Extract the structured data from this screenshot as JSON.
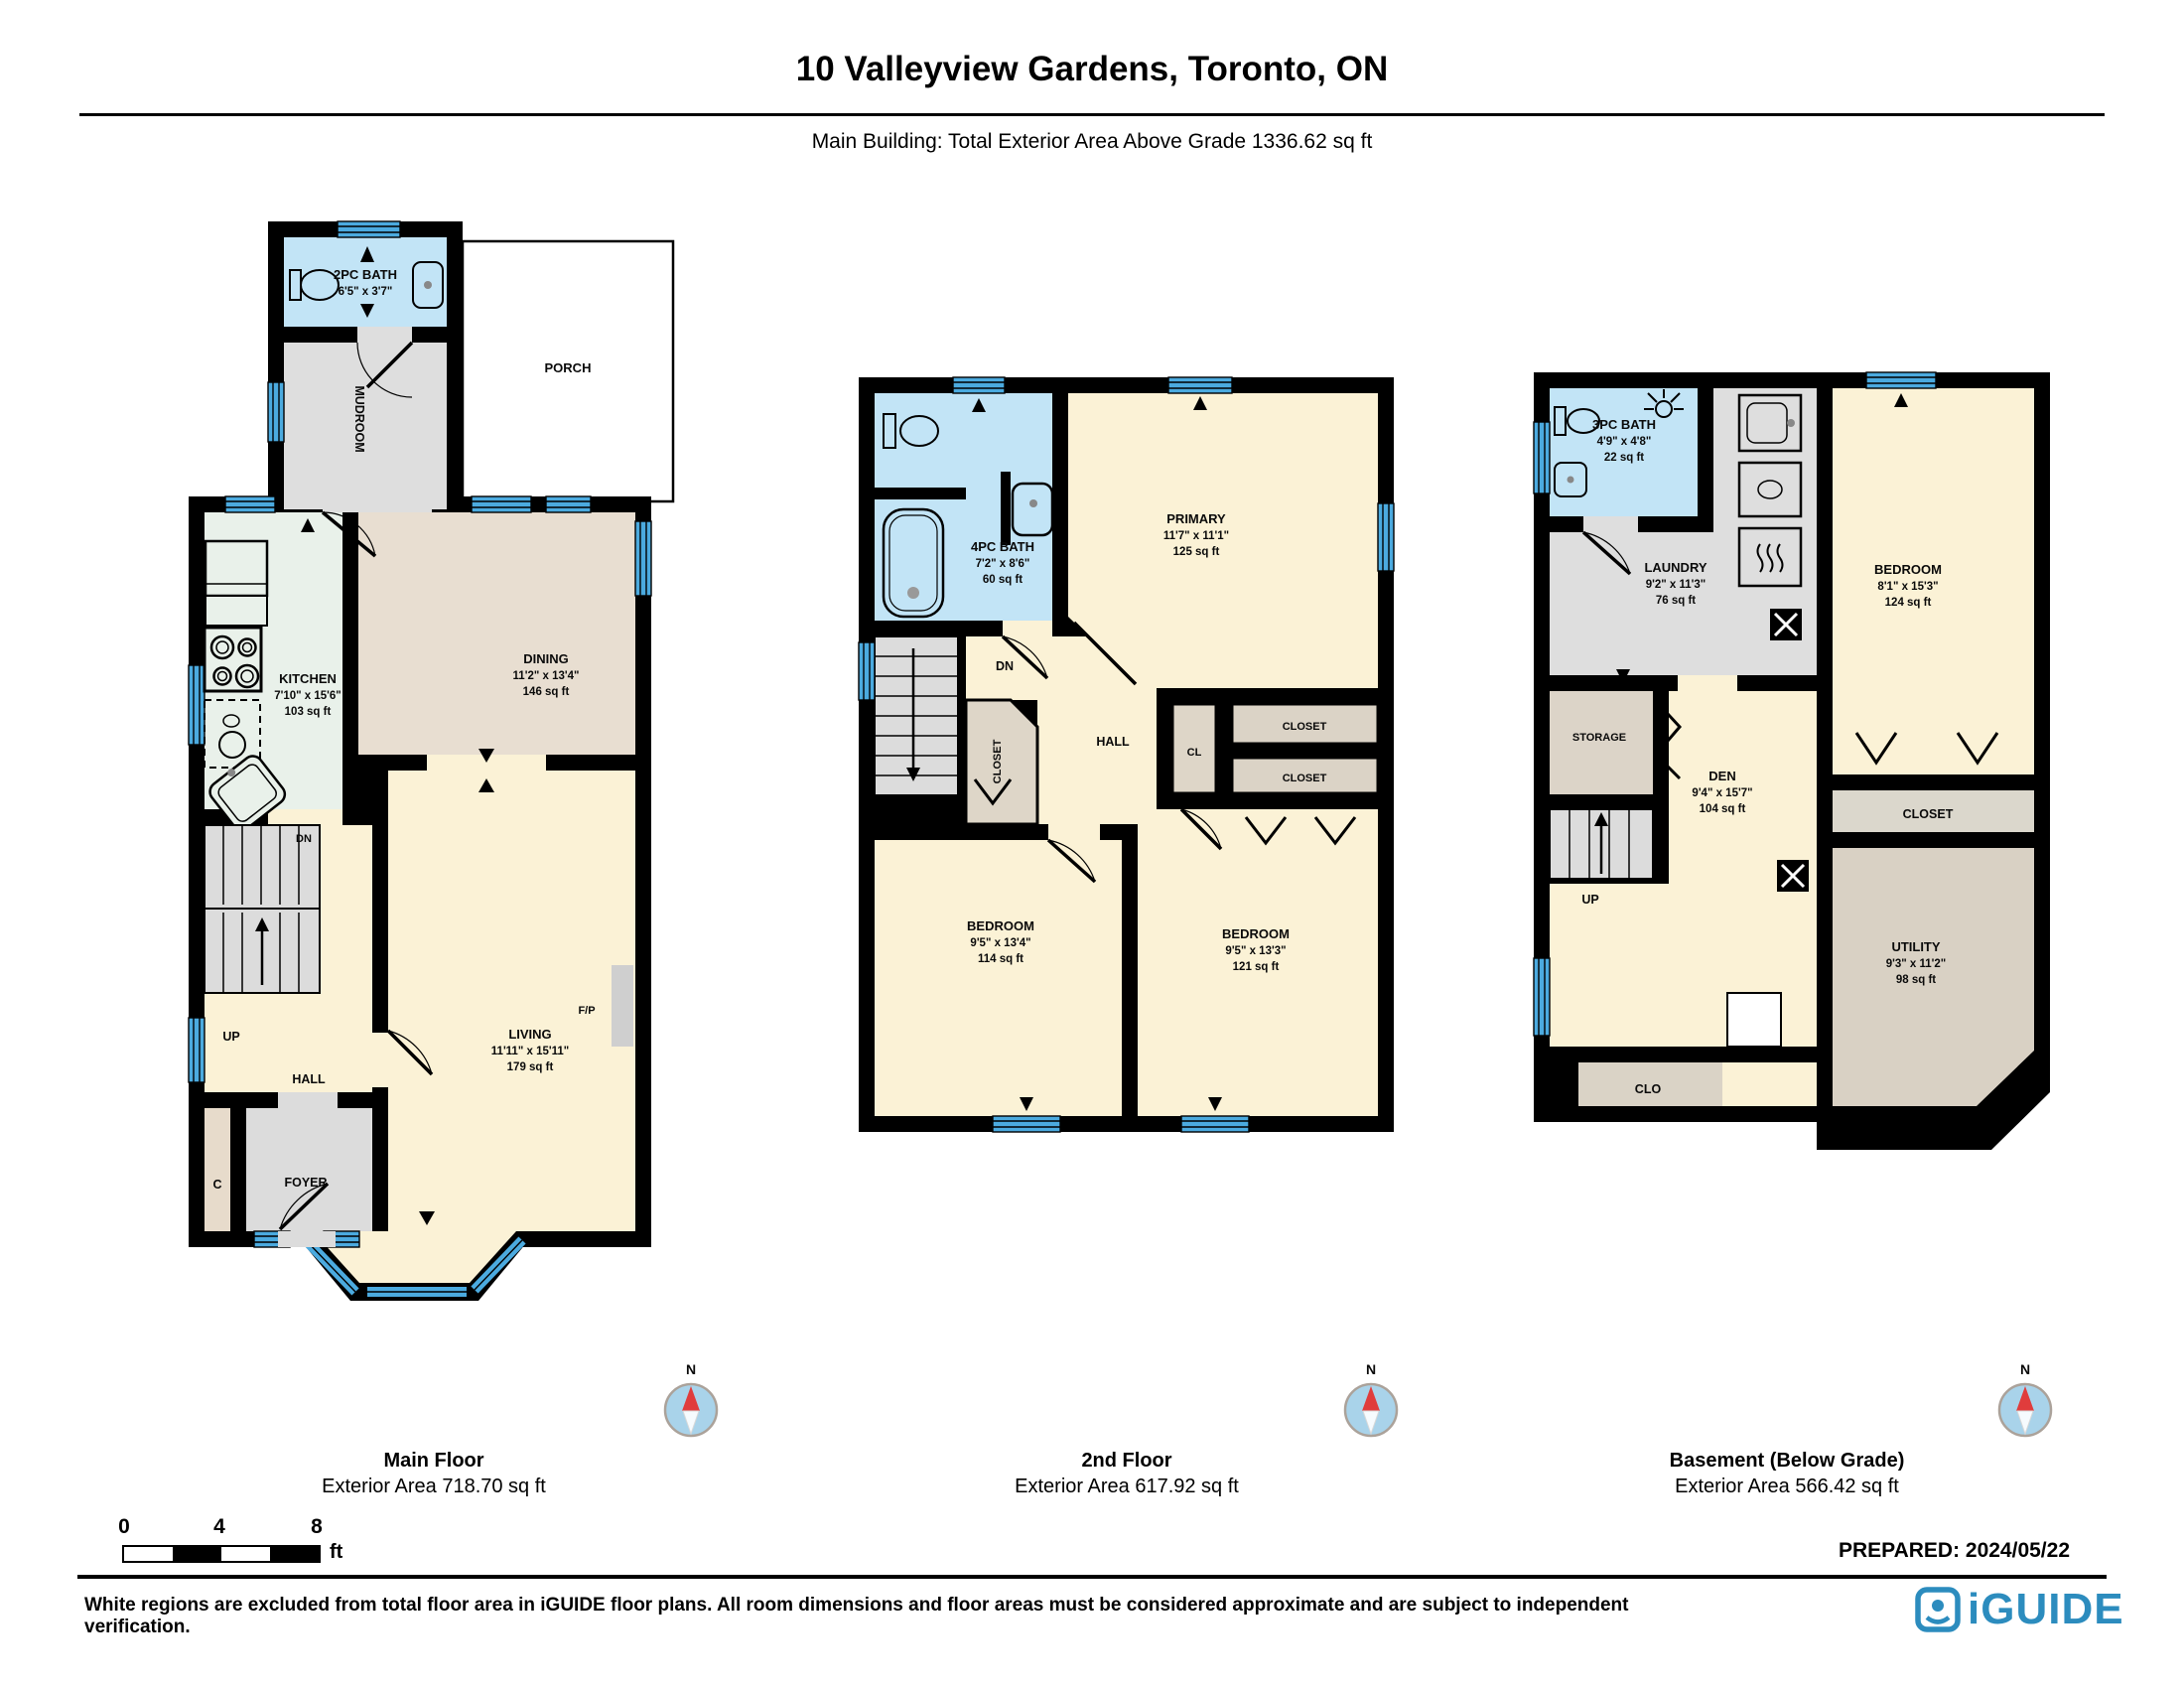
{
  "header": {
    "title": "10 Valleyview Gardens, Toronto, ON",
    "subtitle": "Main Building: Total Exterior Area Above Grade 1336.62 sq ft"
  },
  "plans": {
    "main": {
      "bath2pc": {
        "name": "2PC BATH",
        "dims": "6'5\" x 3'7\""
      },
      "mudroom": "MUDROOM",
      "porch": "PORCH",
      "kitchen": {
        "name": "KITCHEN",
        "dims": "7'10\" x 15'6\"",
        "area": "103 sq ft"
      },
      "dining": {
        "name": "DINING",
        "dims": "11'2\" x 13'4\"",
        "area": "146 sq ft"
      },
      "living": {
        "name": "LIVING",
        "dims": "11'11\" x 15'11\"",
        "area": "179 sq ft"
      },
      "hall": "HALL",
      "up": "UP",
      "dn": "DN",
      "foyer": "FOYER",
      "c": "C",
      "fp": "F/P"
    },
    "second": {
      "bath4pc": {
        "name": "4PC BATH",
        "dims": "7'2\" x 8'6\"",
        "area": "60 sq ft"
      },
      "primary": {
        "name": "PRIMARY",
        "dims": "11'7\" x 11'1\"",
        "area": "125 sq ft"
      },
      "dn": "DN",
      "closet_rot": "CLOSET",
      "hall": "HALL",
      "cl": "CL",
      "closet_a": "CLOSET",
      "closet_b": "CLOSET",
      "bedroom1": {
        "name": "BEDROOM",
        "dims": "9'5\" x 13'4\"",
        "area": "114 sq ft"
      },
      "bedroom2": {
        "name": "BEDROOM",
        "dims": "9'5\" x 13'3\"",
        "area": "121 sq ft"
      }
    },
    "basement": {
      "bath3pc": {
        "name": "3PC BATH",
        "dims": "4'9\" x 4'8\"",
        "area": "22 sq ft"
      },
      "laundry": {
        "name": "LAUNDRY",
        "dims": "9'2\" x 11'3\"",
        "area": "76 sq ft"
      },
      "bedroom": {
        "name": "BEDROOM",
        "dims": "8'1\" x 15'3\"",
        "area": "124 sq ft"
      },
      "storage": "STORAGE",
      "den": {
        "name": "DEN",
        "dims": "9'4\" x 15'7\"",
        "area": "104 sq ft"
      },
      "closet": "CLOSET",
      "utility": {
        "name": "UTILITY",
        "dims": "9'3\" x 11'2\"",
        "area": "98 sq ft"
      },
      "up": "UP",
      "clo": "CLO"
    }
  },
  "floors": [
    {
      "name": "Main Floor",
      "area_label": "Exterior Area 718.70 sq ft"
    },
    {
      "name": "2nd Floor",
      "area_label": "Exterior Area 617.92 sq ft"
    },
    {
      "name": "Basement (Below Grade)",
      "area_label": "Exterior Area 566.42 sq ft"
    }
  ],
  "compass": {
    "label": "N"
  },
  "scale": {
    "t0": "0",
    "t4": "4",
    "t8": "8",
    "unit": "ft"
  },
  "prepared": "PREPARED: 2024/05/22",
  "footer": {
    "disclaimer": "White regions are excluded from total floor area in iGUIDE floor plans. All room dimensions and floor areas must be considered approximate and are subject to independent verification.",
    "logo_text": "iGUIDE"
  },
  "colors": {
    "wall": "#000000",
    "window": "#4BAADF",
    "bath": "#C2E4F6",
    "cream": "#FBF2D6",
    "gray": "#DEDEDE",
    "mint": "#E9F1EA",
    "beige": "#E8DED1",
    "tan": "#DCD4C7",
    "compass_red": "#E03C3C",
    "logo_blue": "#2C8CBE"
  }
}
